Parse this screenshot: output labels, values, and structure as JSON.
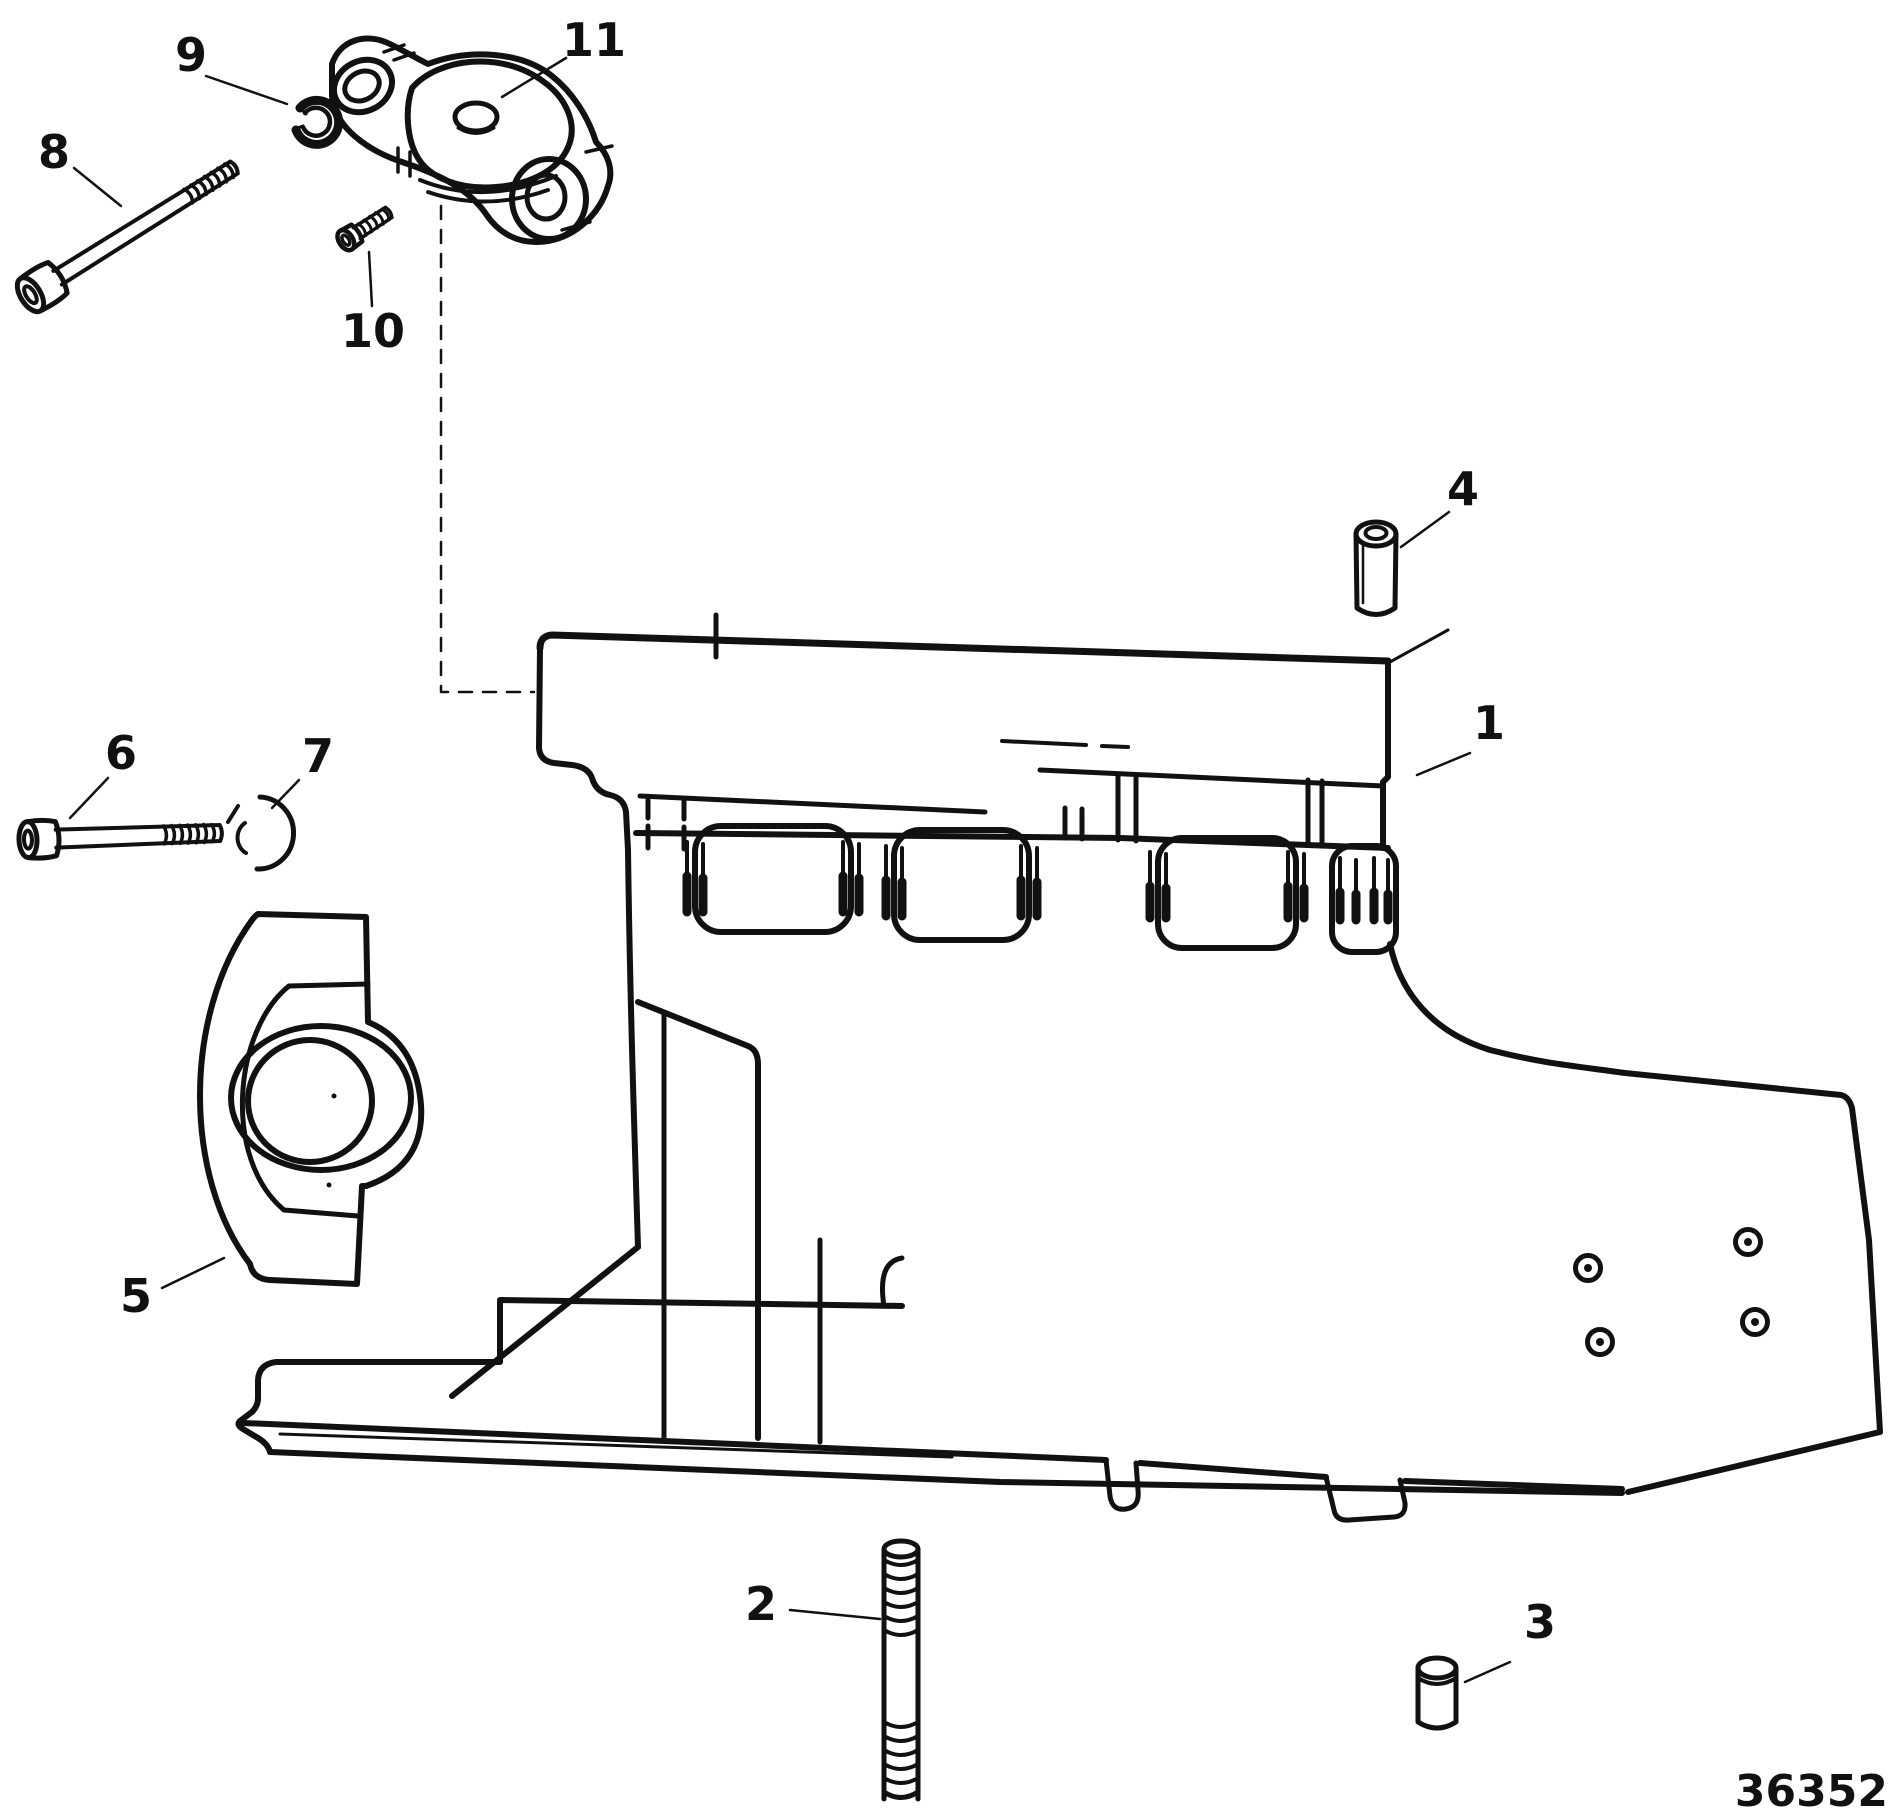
{
  "figure": {
    "kind": "exploded-parts-diagram",
    "subject": "drive housing assembly line drawing",
    "number": "36352"
  },
  "callouts": {
    "c1": "1",
    "c2": "2",
    "c3": "3",
    "c4": "4",
    "c5": "5",
    "c6": "6",
    "c7": "7",
    "c8": "8",
    "c9": "9",
    "c10": "10",
    "c11": "11"
  },
  "colors": {
    "ink": "#111111",
    "background": "#ffffff"
  }
}
